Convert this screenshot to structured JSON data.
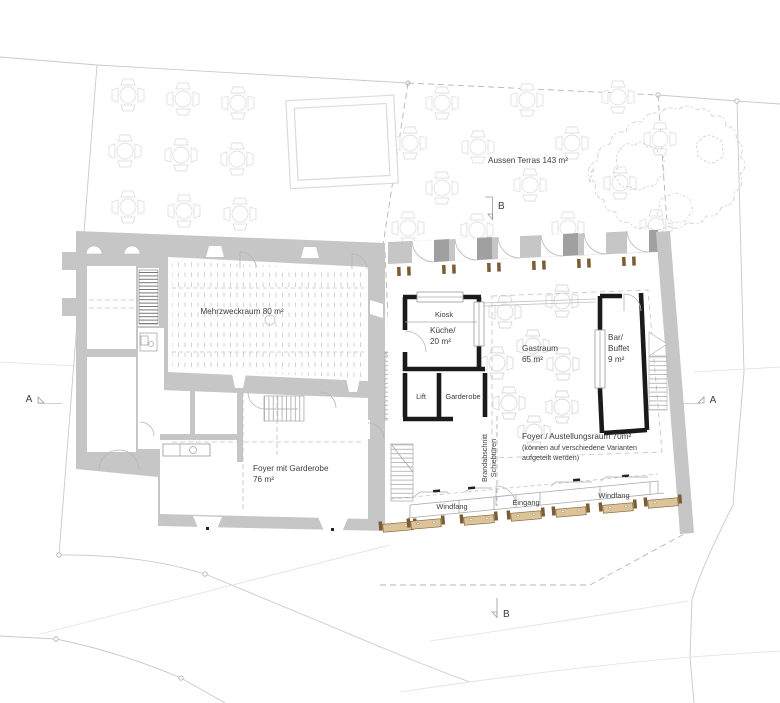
{
  "plan": {
    "terrace": {
      "label": "Aussen Terras 143 m²"
    },
    "left_building": {
      "mehrzweckraum": "Mehrzweckraum 80 m²",
      "foyer_line1": "Foyer mit Garderobe",
      "foyer_line2": "76 m²"
    },
    "right_building": {
      "kiosk": "Kiosk",
      "kueche_line1": "Küche/",
      "kueche_line2": "20 m²",
      "gastraum_line1": "Gastraum",
      "gastraum_line2": "65 m²",
      "bar_line1": "Bar/",
      "bar_line2": "Buffet",
      "bar_line3": "9 m²",
      "lift": "Lift",
      "garderobe": "Garderobe",
      "ausstellung_line1": "Foyer / Austellungsraum 70m²",
      "ausstellung_line2": "(können auf verschiedene Varianten",
      "ausstellung_line3": "aufgeteilt werden)",
      "brandabschnitt_line1": "Brandabschnitt",
      "brandabschnitt_line2": "Schiebtüren",
      "windfang_left": "Windfang",
      "eingang": "Eingang",
      "windfang_right": "Windfang"
    },
    "section_markers": {
      "a_left": "A",
      "a_right": "A",
      "b_top": "B",
      "b_bottom": "B"
    },
    "colors": {
      "existing_wall": "#c6c6c6",
      "pier_dark": "#a0a0a0",
      "new_wall": "#1a1a1a",
      "bench_wood": "#dcc49a",
      "bench_post": "#7b5c33",
      "furniture_line": "#dedede",
      "text": "#3c3c3c"
    }
  }
}
